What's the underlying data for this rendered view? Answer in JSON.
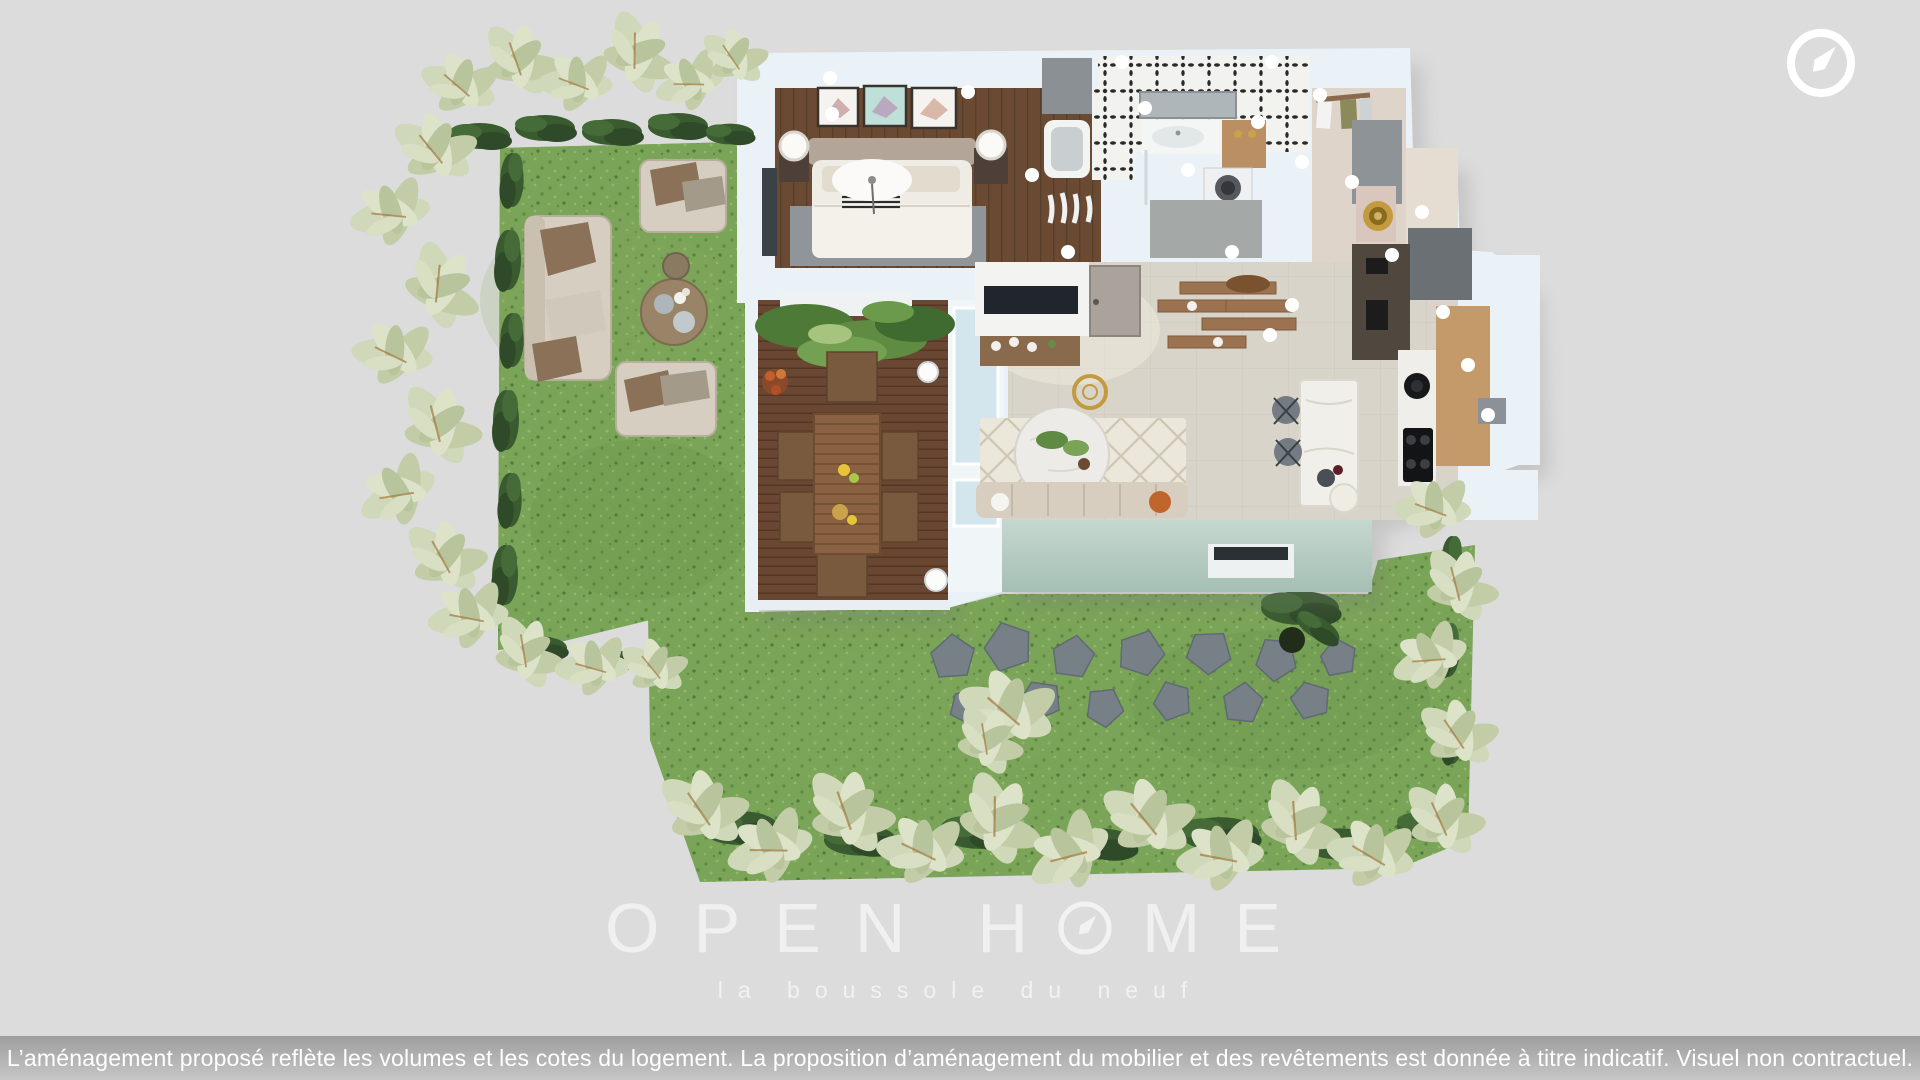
{
  "app": {
    "background_color": "#dcdcdc",
    "view": "3D floor plan render with private garden"
  },
  "compass_badge": {
    "icon": "compass-icon"
  },
  "watermark": {
    "brand_full": "OPEN HOME",
    "brand_word_1": "OPEN",
    "brand_word_2_prefix": "H",
    "brand_word_2_suffix": "ME",
    "tagline": "la boussole du neuf"
  },
  "disclaimer": {
    "text": "L’aménagement proposé reflète les volumes et les cotes du logement. La proposition d’aménagement du mobilier et des revêtements est donnée à titre indicatif. Visuel non contractuel."
  },
  "colors": {
    "background": "#dcdcdc",
    "grass": "#7aa458",
    "grass_dark": "#5e8a43",
    "grass_light": "#93b86b",
    "hedge_dark": "#3a5a30",
    "foliage_pale": "#cdd6b5",
    "building_wall": "#eaf2f8",
    "building_wall_shade": "#cfe0ea",
    "building_wall_seafoam": "#b6cdc4",
    "deck_wood": "#6a4732",
    "interior_wood": "#6b4a33",
    "living_floor": "#d8d4ca",
    "accent_gold": "#c49a3f",
    "stone_gray": "#778087",
    "disclaimer_top": "#9e9e9e",
    "disclaimer_bottom": "#c6c6c6",
    "text_white": "#ffffff"
  },
  "floorplan": {
    "rooms": [
      "bedroom",
      "dressing",
      "bathroom",
      "entry-hall",
      "living-room",
      "kitchen",
      "terrace"
    ],
    "garden_features": [
      "lawn",
      "hedges",
      "olive-trees",
      "outdoor-lounge-set",
      "outdoor-dining-set",
      "stepping-stones",
      "green-wall-planters"
    ]
  }
}
